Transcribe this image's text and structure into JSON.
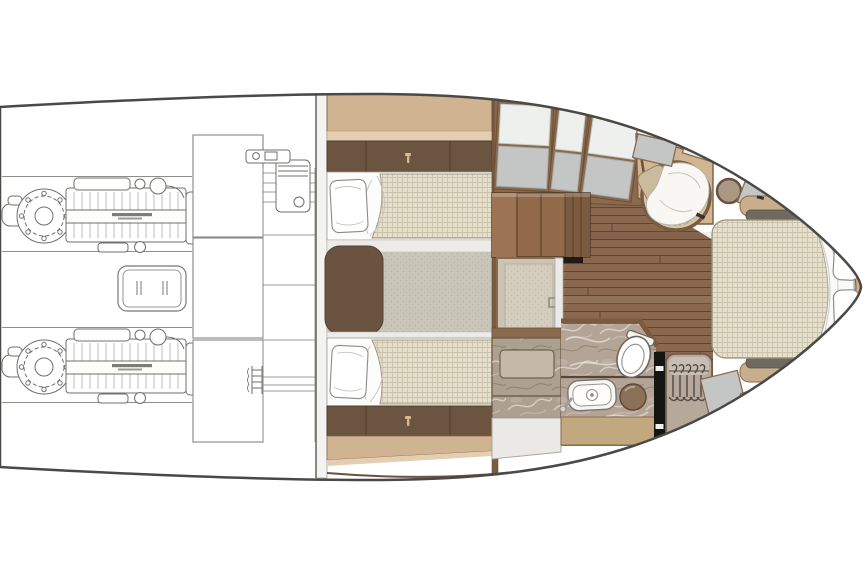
{
  "page": {
    "title": "Motor yacht lower-deck interior floor plan",
    "type": "floor-plan",
    "orientation": "bow-right-stern-left"
  },
  "palette": {
    "hull_line": "#4a4946",
    "gunwale_line": "#6a5140",
    "engine_art": "#6f6f6c",
    "tan_cabinet": "#d0b492",
    "tan_light": "#e3ceb1",
    "tan_vanity": "#c2a87e",
    "brown_cabinet": "#6b5440",
    "wood_frame": "#7b5a3e",
    "wood_floor": "#8a6850",
    "wood_plank_line": "#5f4730",
    "stair_wood": "#916a4a",
    "carpet": "#c9c5b8",
    "panel_white": "#eef0ee",
    "panel_gray": "#c3c6c5",
    "panel_gray_dark": "#b9bcbb",
    "bed_fabric": "#e6dfcc",
    "marble": "#b4a496",
    "marble_shower": "#aca091",
    "wardrobe_taupe": "#b7a89c",
    "rattan_chair": "#d8c6a7",
    "stool_brown": "#8a7157",
    "side_table": "#a89884",
    "deck_gray": "#d9dbda",
    "door_black": "#151513",
    "mat_dark": "#6f695f",
    "white": "#ffffff"
  },
  "rooms": [
    {
      "id": "engine-room",
      "side": "aft",
      "items": [
        "twin-engines",
        "generator",
        "fuel-tanks",
        "water-heater",
        "shelf-rack",
        "ladder"
      ]
    },
    {
      "id": "twin-guest-cabin",
      "side": "midship-aft",
      "items": [
        "upper-lockers",
        "drawer-bands",
        "two-single-beds",
        "pillows",
        "nightstand",
        "carpet"
      ]
    },
    {
      "id": "companionway",
      "side": "midship",
      "items": [
        "stair-block",
        "vestibule-door",
        "teak-floor",
        "hull-side-lockers"
      ]
    },
    {
      "id": "bathroom",
      "side": "midship-fwd",
      "items": [
        "shower",
        "washbasin",
        "faucet",
        "toilet",
        "stool",
        "vanity"
      ]
    },
    {
      "id": "wardrobe",
      "side": "midship-fwd",
      "items": [
        "hanging-rail",
        "five-hangers",
        "mirror-door"
      ]
    },
    {
      "id": "master-cabin",
      "side": "bow",
      "items": [
        "double-bed",
        "pillows",
        "folded-sheet",
        "lounge-chair",
        "blanket",
        "side-table",
        "bench-mats",
        "bow-lockers"
      ]
    }
  ]
}
